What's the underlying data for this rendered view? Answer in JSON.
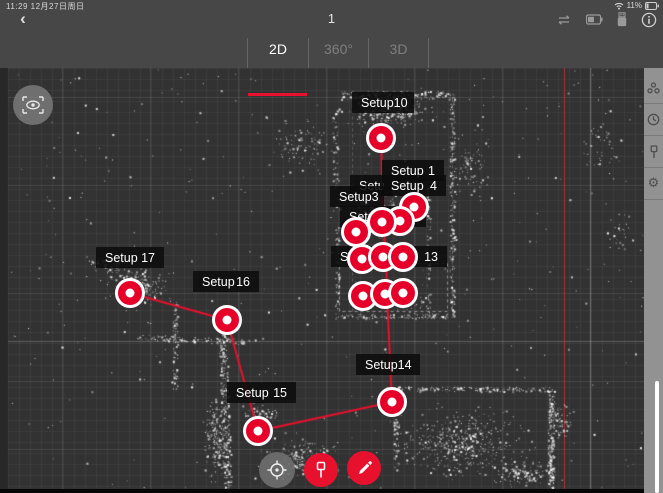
{
  "status_bar": {
    "left_text": "11:29  12月27日周日",
    "battery_percent": "11%",
    "icons": [
      "wifi-icon",
      "battery-icon"
    ]
  },
  "toolbar": {
    "back_glyph": "‹",
    "title": "1",
    "icons": [
      "repeat-icon",
      "battery-status-icon",
      "usb-drive-icon",
      "info-icon"
    ]
  },
  "tabs": [
    {
      "label": "2D",
      "active": true
    },
    {
      "label": "360°",
      "active": false
    },
    {
      "label": "3D",
      "active": false
    }
  ],
  "colors": {
    "accent_red": "#e8112d",
    "marker_red": "#e60029",
    "canvas_bg": "#323232",
    "topbar_bg": "#474747",
    "sidebar_bg": "#929292",
    "label_bg": "rgba(13,13,13,0.88)"
  },
  "map": {
    "labels": [
      {
        "text": "Setup",
        "number": "10",
        "x": 352,
        "y": 92,
        "w": 62,
        "pointer": true,
        "ptr_x": 31
      },
      {
        "text": "Setup",
        "number": "1",
        "x": 382,
        "y": 160,
        "w": 62,
        "pointer": false,
        "ptr_x": 0
      },
      {
        "text": "Setu",
        "number": "",
        "x": 350,
        "y": 175,
        "w": 42,
        "pointer": false,
        "ptr_x": 0
      },
      {
        "text": "Setup",
        "number": "4",
        "x": 382,
        "y": 175,
        "w": 64,
        "pointer": false,
        "ptr_x": 0
      },
      {
        "text": "Setup",
        "number": "3",
        "x": 330,
        "y": 186,
        "w": 54,
        "pointer": false,
        "ptr_x": 0
      },
      {
        "text": "Setup",
        "number": "7",
        "x": 340,
        "y": 206,
        "w": 86,
        "pointer": false,
        "ptr_x": 0
      },
      {
        "text": "Setup",
        "number": "13",
        "x": 331,
        "y": 246,
        "w": 116,
        "pointer": false,
        "ptr_x": 0
      },
      {
        "text": "Setup",
        "number": "17",
        "x": 96,
        "y": 247,
        "w": 68,
        "pointer": true,
        "ptr_x": 31
      },
      {
        "text": "Setup",
        "number": "16",
        "x": 193,
        "y": 271,
        "w": 66,
        "pointer": true,
        "ptr_x": 33
      },
      {
        "text": "Setup",
        "number": "15",
        "x": 227,
        "y": 382,
        "w": 69,
        "pointer": true,
        "ptr_x": 31
      },
      {
        "text": "Setup",
        "number": "14",
        "x": 356,
        "y": 354,
        "w": 64,
        "pointer": true,
        "ptr_x": 34
      }
    ],
    "markers": [
      {
        "x": 381,
        "y": 138
      },
      {
        "x": 414,
        "y": 207
      },
      {
        "x": 400,
        "y": 221
      },
      {
        "x": 382,
        "y": 222
      },
      {
        "x": 356,
        "y": 232
      },
      {
        "x": 362,
        "y": 259
      },
      {
        "x": 383,
        "y": 257
      },
      {
        "x": 403,
        "y": 257
      },
      {
        "x": 363,
        "y": 296
      },
      {
        "x": 385,
        "y": 294
      },
      {
        "x": 403,
        "y": 293
      },
      {
        "x": 130,
        "y": 293
      },
      {
        "x": 227,
        "y": 320
      },
      {
        "x": 258,
        "y": 431
      },
      {
        "x": 392,
        "y": 402
      }
    ],
    "path": [
      [
        130,
        293
      ],
      [
        227,
        320
      ],
      [
        258,
        431
      ],
      [
        392,
        402
      ],
      [
        387,
        295
      ],
      [
        386,
        257
      ],
      [
        383,
        222
      ],
      [
        381,
        138
      ]
    ],
    "red_guide_x": 564
  },
  "controls": {
    "eye": "preview-eye-icon",
    "locate": "locate-crosshair-icon",
    "add_marker": "pin-marker-icon",
    "measure": "pencil-icon"
  },
  "sidebar_icons": [
    "registration-cluster-icon",
    "clock-icon",
    "pin-icon",
    "gear-icon"
  ],
  "sidebar_gear_glyph": "⚙"
}
